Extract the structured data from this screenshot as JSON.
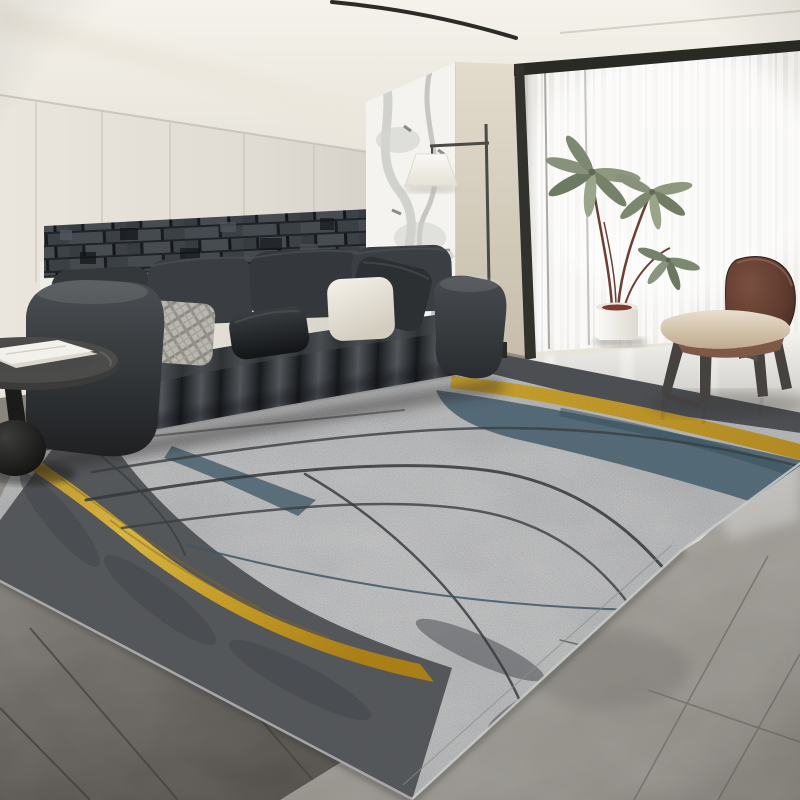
{
  "scene": {
    "description": "Product photo of an abstract area rug in a modern living room",
    "room": "living room",
    "visible_text": "",
    "style": "modern minimal gray"
  },
  "palette": {
    "page_bg": "#e8e4da",
    "ceiling": "#f0ece3",
    "wall_left": "#e2ded5",
    "wall_art": "#3e4347",
    "marble_panel": "#f4f3f0",
    "wall_beige": "#d6cfc0",
    "window_frame": "#2b2b26",
    "curtain": "#f7f6f3",
    "floor_bright": "#eceae6",
    "floor_dark_left": "#6b6763",
    "floor_light_right": "#a5a29c",
    "rug_base": "#b5b6b7",
    "rug_dark_band": "#54575a",
    "rug_teal": "#4e6877",
    "rug_gold": "#e3b322",
    "rug_line": "#35393d",
    "sofa_leather": "#36393d",
    "pillow_cream": "#efeae0",
    "pillow_plaid": "#b9b6b0",
    "pillow_dark": "#24272a",
    "chair_wood": "#5d3a2e",
    "chair_seat": "#d9cdba",
    "plant_green": "#828d71",
    "lamp_shade": "#f7f4ee",
    "table_black": "#1c1c1b"
  },
  "objects": {
    "rug": {
      "label": "abstract gray area rug",
      "design": {
        "field": "mottled light gray",
        "edge_band": "dark charcoal grunge along left and front edges",
        "ribbons": [
          "wide gold curved ribbon lower-left",
          "thin gold ribbon upper-right",
          "teal band along gold",
          "teal streak left-center"
        ],
        "lines": "thin dark wavy lines across field"
      }
    },
    "sofa": {
      "label": "charcoal channel-tufted leather sofa",
      "pillows": [
        "cream",
        "gray plaid",
        "charcoal",
        "cream",
        "charcoal"
      ]
    },
    "wall_art": {
      "label": "dark 3D brick accent panel"
    },
    "marble_panel": {
      "label": "white marble feature panel"
    },
    "floor_lamp": {
      "label": "black floor lamp with white trapezoid shade"
    },
    "window": {
      "label": "floor-to-ceiling window with sheer vertical curtains"
    },
    "plant": {
      "label": "potted plant with sage green leaves in white pot"
    },
    "chair": {
      "label": "walnut molded plywood lounge chair"
    },
    "side_table": {
      "label": "black pedestal side table with white papers"
    },
    "floor": {
      "label": "gray marble tile floor, darker left, glossy right"
    },
    "ceiling": {
      "label": "cream ceiling with recessed light slit"
    }
  }
}
